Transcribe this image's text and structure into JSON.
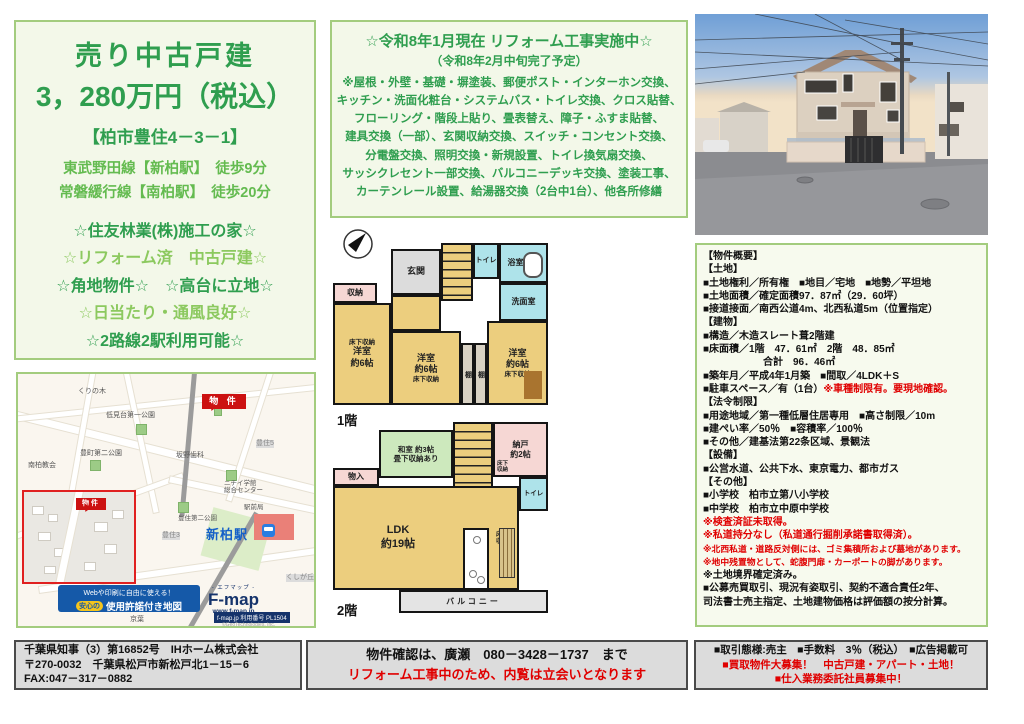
{
  "headline": {
    "title": "売り中古戸建",
    "price": "3，280万円（税込）",
    "address": "【柏市豊住4－3－1】",
    "access": [
      "東武野田線【新柏駅】　徒歩9分",
      "常磐緩行線【南柏駅】　徒歩20分"
    ],
    "features": [
      {
        "text": "☆住友林業(株)施工の家☆",
        "tone": "dark"
      },
      {
        "text": "☆リフォーム済　中古戸建☆",
        "tone": "light"
      },
      {
        "text": "☆角地物件☆　☆高台に立地☆",
        "tone": "dark"
      },
      {
        "text": "☆日当たり・通風良好☆",
        "tone": "light"
      },
      {
        "text": "☆2路線2駅利用可能☆",
        "tone": "dark"
      }
    ]
  },
  "renovation": {
    "title": "☆令和8年1月現在 リフォーム工事実施中☆",
    "subtitle": "（令和8年2月中旬完了予定）",
    "lines": [
      "※屋根・外壁・基礎・塀塗装、郵便ポスト・インターホン交換、",
      "キッチン・洗面化粧台・システムバス・トイレ交換、クロス貼替、",
      "フローリング・階段上貼り、畳表替え、障子・ふすま貼替、",
      "建具交換（一部）、玄関収納交換、スイッチ・コンセント交換、",
      "分電盤交換、照明交換・新規設置、トイレ換気扇交換、",
      "サッシクレセント一部交換、バルコニーデッキ交換、塗装工事、",
      "カーテンレール設置、給湯器交換（2台中1台）、他各所修繕"
    ]
  },
  "details": {
    "lines": [
      [
        {
          "t": "【物件概要】",
          "c": "b"
        }
      ],
      [
        {
          "t": "【土地】",
          "c": "b"
        }
      ],
      [
        {
          "t": "■土地権利／所有権　■地目／宅地　■地勢／平坦地",
          "c": "b"
        }
      ],
      [
        {
          "t": "■土地面積／確定面積97．87㎡（29．60坪）",
          "c": "b"
        }
      ],
      [
        {
          "t": "■接道接面／南西公道4m、北西私道5m（位置指定）",
          "c": "b"
        }
      ],
      [
        {
          "t": "【建物】",
          "c": "b"
        }
      ],
      [
        {
          "t": "■構造／木造スレート葺2階建",
          "c": "b"
        }
      ],
      [
        {
          "t": "■床面積／1階　47．61㎡　2階　48．85㎡",
          "c": "b"
        }
      ],
      [
        {
          "t": "　　　　　　合計　96．46㎡",
          "c": "b"
        }
      ],
      [
        {
          "t": "■築年月／平成4年1月築　■間取／4LDK＋S",
          "c": "b"
        }
      ],
      [
        {
          "t": "■駐車スペース／有（1台）",
          "c": "b"
        },
        {
          "t": "※車種制限有。要現地確認。",
          "c": "r"
        }
      ],
      [
        {
          "t": "【法令制限】",
          "c": "b"
        }
      ],
      [
        {
          "t": "■用途地域／第一種低層住居専用　■高さ制限／10m",
          "c": "b"
        }
      ],
      [
        {
          "t": "■建ぺい率／50％　■容積率／100％",
          "c": "b"
        }
      ],
      [
        {
          "t": "■その他／建基法第22条区域、景観法",
          "c": "b"
        }
      ],
      [
        {
          "t": "【設備】",
          "c": "b"
        }
      ],
      [
        {
          "t": "■公営水道、公共下水、東京電力、都市ガス",
          "c": "b"
        }
      ],
      [
        {
          "t": "【その他】",
          "c": "b"
        }
      ],
      [
        {
          "t": "■小学校　柏市立第八小学校",
          "c": "b"
        }
      ],
      [
        {
          "t": "■中学校　柏市立中原中学校",
          "c": "b"
        }
      ],
      [
        {
          "t": "※検査済証未取得。",
          "c": "r"
        }
      ],
      [
        {
          "t": "※私道持分なし（私道通行掘削承諾書取得済）。",
          "c": "r"
        }
      ],
      [
        {
          "t": "※北西私道・道路反対側には、ゴミ集積所および墓地があります。",
          "c": "rs"
        }
      ],
      [
        {
          "t": "※地中残置物として、蛇腹門扉・カーポートの脚があります。",
          "c": "rs"
        }
      ],
      [
        {
          "t": "※土地境界確定済み。",
          "c": "b"
        }
      ],
      [
        {
          "t": "■公募売買取引、現況有姿取引、契約不適合責任2年、",
          "c": "b"
        }
      ],
      [
        {
          "t": "司法書士売主指定、土地建物価格は評価額の按分計算。",
          "c": "b"
        }
      ]
    ]
  },
  "floorplan": {
    "floor1_label": "1階",
    "floor2_label": "2階",
    "rooms": {
      "genkan": "玄関",
      "toilet": "トイレ",
      "bath": "浴室",
      "washroom": "洗面室",
      "storage": "収納",
      "underfloor": "床下収納",
      "underfloor2": "床下\n収納",
      "western6": "洋室\n約6帖",
      "shelf": "棚",
      "washitsu": "和室 約3帖\n畳下収納あり",
      "nando": "納戸\n約2帖",
      "monoire": "物入",
      "ldk": "LDK\n約19帖",
      "balcony": "バルコニー"
    }
  },
  "map": {
    "labels": {
      "kurinoki": "くりの木",
      "park1": "低見台第一公園",
      "bukken": "物 件",
      "bukken_inset": "物件",
      "park2": "豊町第二公園",
      "church": "南柏教会",
      "dental": "坂野歯科",
      "toyosumi5": "豊住5",
      "nichii": "ニチイ学館\n総合センター",
      "park3": "豊住第二公園",
      "ekimae": "駅前局",
      "station": "新柏駅",
      "toyosumi3": "豊住3",
      "tsukushi": "つくしが丘1",
      "kushigaoka": "くしが丘",
      "keiyo": "京葉"
    },
    "banner_line1": "Webや印刷に自由に使える！",
    "banner_badge": "安心の",
    "banner_line2": "使用許諾付き地図",
    "fmap_reading": "- エフマップ -",
    "fmap_name": "F-map",
    "fmap_url": "www.f-map.jp",
    "fmap_code": "f-map.jp 利用番号 PL1504",
    "fmap_copyright": "©GeoTechnologies, Inc."
  },
  "footer": {
    "left": [
      [
        {
          "t": "千葉県知事（3）第16852号　IHホーム株式会社",
          "c": "b"
        }
      ],
      [
        {
          "t": "〒270-0032　千葉県松戸市新松戸北1－15－6",
          "c": "b"
        }
      ],
      [
        {
          "t": "FAX:047－317－0882",
          "c": "b"
        }
      ]
    ],
    "middle": [
      [
        {
          "t": "物件確認は、廣瀬　080－3428－1737　まで",
          "c": "b"
        }
      ],
      [
        {
          "t": "リフォーム工事中のため、内覧は立会いとなります",
          "c": "r"
        }
      ]
    ],
    "right": [
      [
        {
          "t": "■取引態様:売主　■手数料　3％（税込）　■広告掲載可",
          "c": "b"
        }
      ],
      [
        {
          "t": "■買取物件大募集！　中古戸建・アパート・土地！",
          "c": "r"
        }
      ],
      [
        {
          "t": "■仕入業務委託社員募集中！",
          "c": "r"
        }
      ]
    ]
  },
  "colors": {
    "green_dark": "#2f9e4f",
    "green_light": "#8cc95f",
    "box_border": "#a3cc7e",
    "red": "#e00000",
    "badge_red": "#cc1111",
    "station_blue": "#1560c8"
  }
}
